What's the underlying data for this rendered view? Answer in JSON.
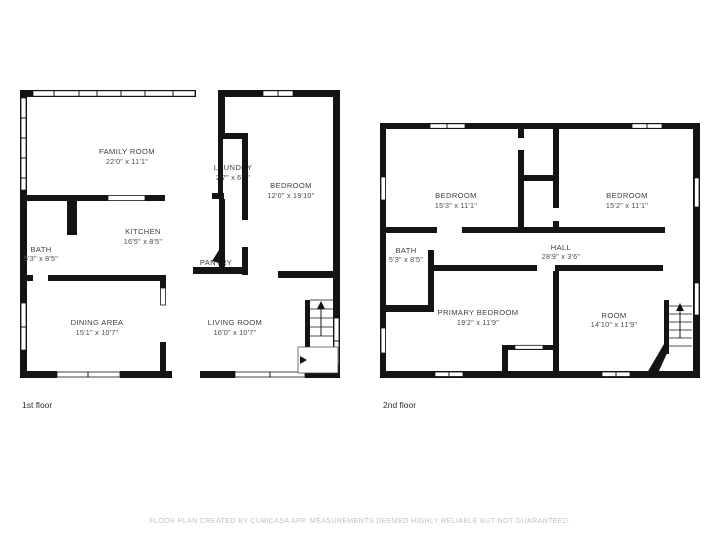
{
  "document": {
    "type": "floor-plan",
    "background": "#ffffff",
    "disclaimer": "FLOOR PLAN CREATED BY CUBICASA APP. MEASUREMENTS DEEMED HIGHLY RELIABLE BUT NOT GUARANTEED."
  },
  "colors": {
    "wall": "#141414",
    "room_label": "#3f3f3f",
    "caption": "#2e2e2e",
    "disclaimer_text": "#c2c2c2"
  },
  "floors": [
    {
      "caption": "1st floor",
      "rooms": [
        {
          "name": "FAMILY ROOM",
          "dims": "22'0\" x 11'1\""
        },
        {
          "name": "LAUNDRY",
          "dims": "2'7\" x 6'3\""
        },
        {
          "name": "BEDROOM",
          "dims": "12'0\" x 19'10\""
        },
        {
          "name": "KITCHEN",
          "dims": "16'5\" x 8'5\""
        },
        {
          "name": "BATH",
          "dims": "5'3\" x 8'5\""
        },
        {
          "name": "PANTRY",
          "dims": "2'6\" x 1'6\""
        },
        {
          "name": "DINING AREA",
          "dims": "15'1\" x 10'7\""
        },
        {
          "name": "LIVING ROOM",
          "dims": "16'0\" x 10'7\""
        }
      ]
    },
    {
      "caption": "2nd floor",
      "rooms": [
        {
          "name": "BEDROOM",
          "dims": "15'3\" x 11'1\""
        },
        {
          "name": "BEDROOM",
          "dims": "15'2\" x 11'1\""
        },
        {
          "name": "HALL",
          "dims": "28'9\" x 3'6\""
        },
        {
          "name": "BATH",
          "dims": "5'3\" x 8'5\""
        },
        {
          "name": "PRIMARY BEDROOM",
          "dims": "19'2\" x 11'9\""
        },
        {
          "name": "ROOM",
          "dims": "14'10\" x 11'9\""
        }
      ]
    }
  ]
}
